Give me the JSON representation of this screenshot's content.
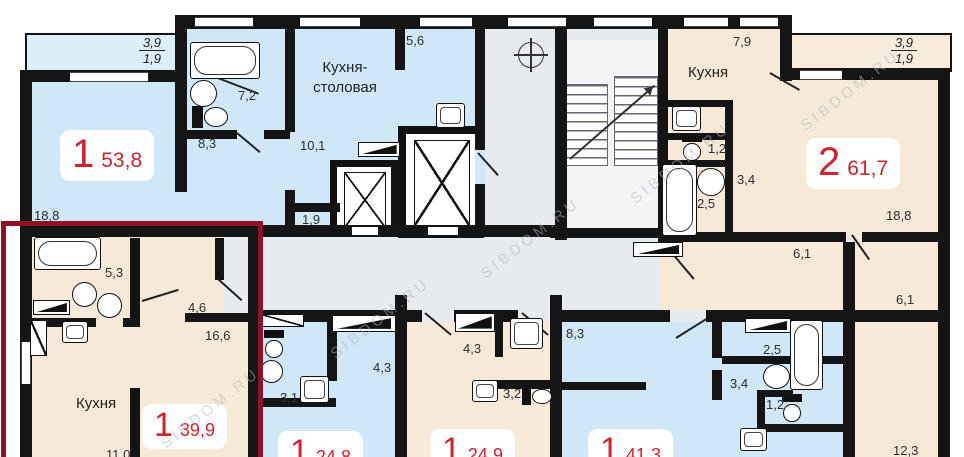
{
  "watermark": {
    "text": "SIBDOM.RU"
  },
  "balcony": {
    "width": "3,9",
    "depth": "1,9"
  },
  "apartments": {
    "a53": {
      "num": "1",
      "area": "53,8",
      "dims": {
        "bath": "7,2",
        "hall": "8,3",
        "room": "10,1",
        "closet": "1,9",
        "top": "5,6",
        "living": "18,8"
      },
      "labels": {
        "kitchen_dining_line1": "Кухня-",
        "kitchen_dining_line2": "столовая"
      }
    },
    "a61": {
      "num": "2",
      "area": "61,7",
      "dims": {
        "kitchen": "7,9",
        "wc": "1,2",
        "hall": "3,4",
        "bath": "2,5",
        "living": "18,8",
        "hallway": "6,1",
        "corridor": "6,1",
        "bedroom": "12,3"
      },
      "labels": {
        "kitchen": "Кухня"
      }
    },
    "a39": {
      "num": "1",
      "area": "39,9",
      "dims": {
        "bath": "5,3",
        "hall": "4,6",
        "room": "16,6",
        "kitchen": "11,0"
      },
      "labels": {
        "kitchen": "Кухня"
      }
    },
    "a24a": {
      "num": "1",
      "area": "24,8",
      "dims": {
        "bath": "3,1",
        "hall": "4,3"
      }
    },
    "a24b": {
      "num": "1",
      "area": "24,9",
      "dims": {
        "hall": "4,3",
        "bath": "3,2"
      }
    },
    "a41": {
      "num": "1",
      "area": "41,3",
      "dims": {
        "hall": "8,3",
        "bath": "2,5",
        "corridor": "3,4",
        "wc": "1,2"
      }
    }
  }
}
